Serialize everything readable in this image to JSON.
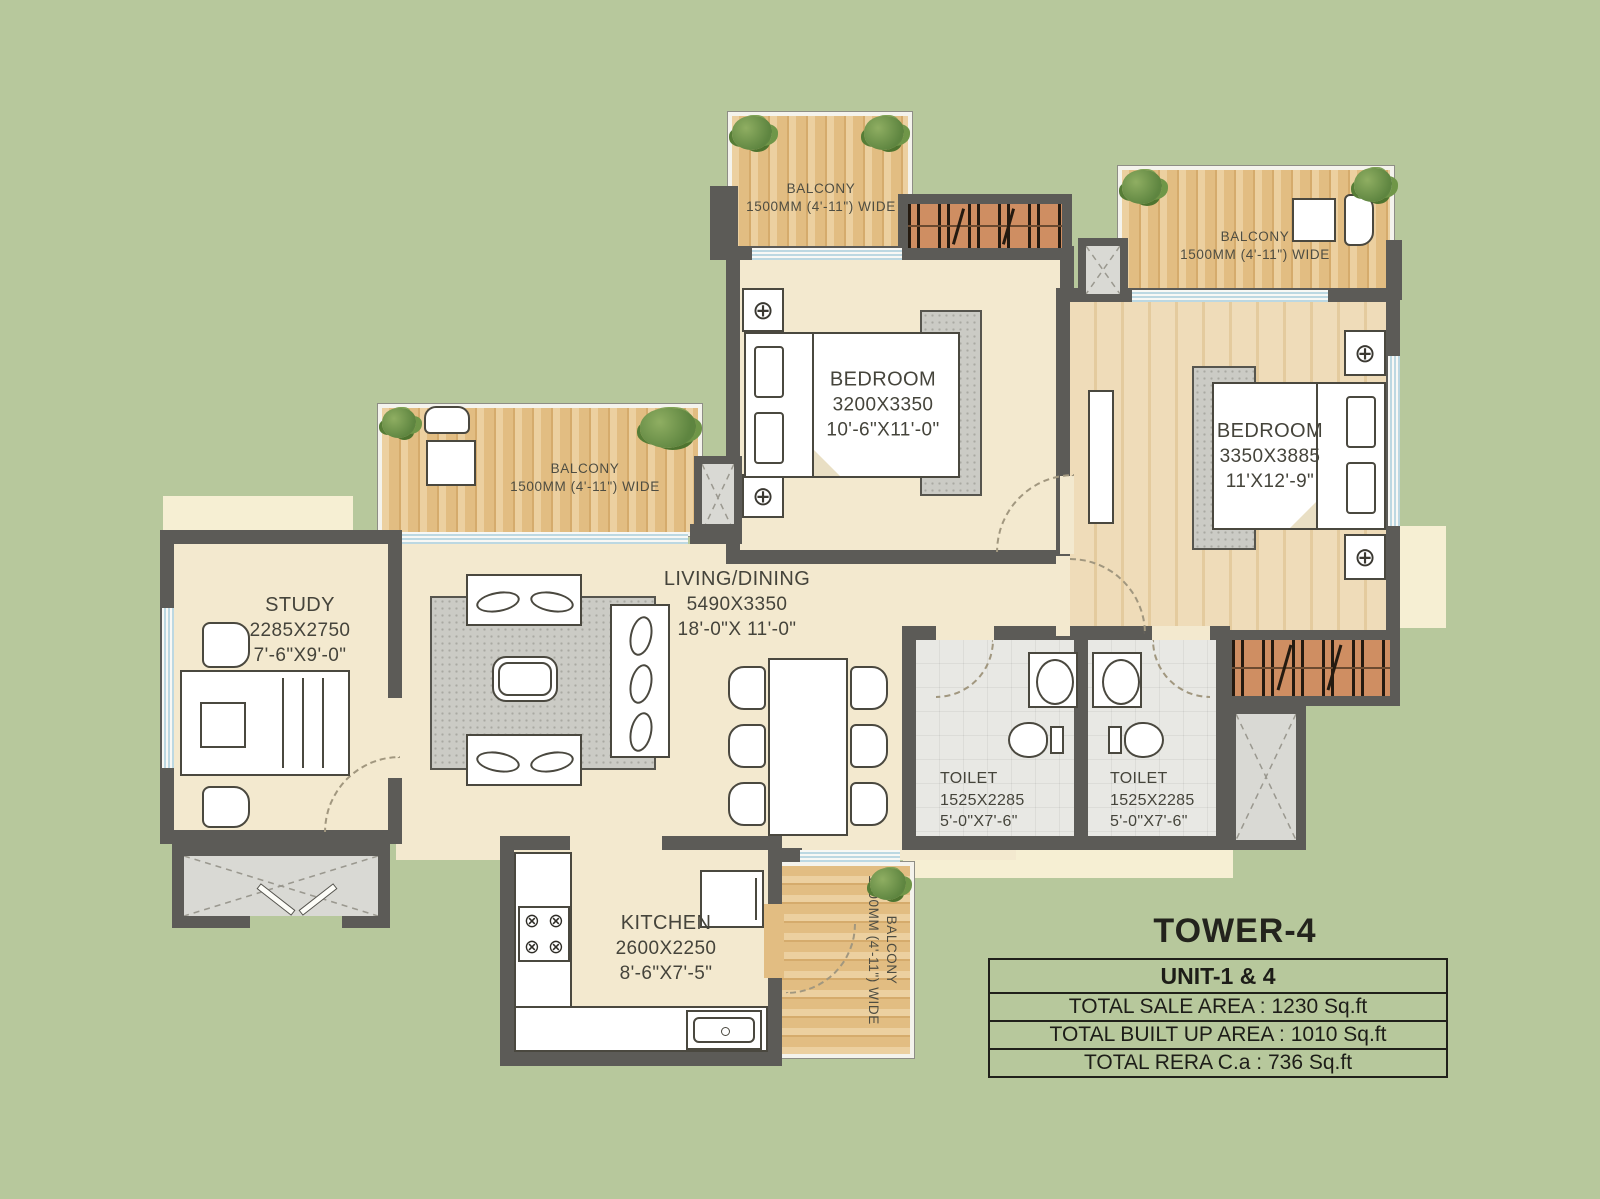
{
  "title": {
    "tower": "TOWER-4"
  },
  "info_table": {
    "unit_label": "UNIT-1 & 4",
    "rows": [
      "TOTAL SALE AREA : 1230 Sq.ft",
      "TOTAL BUILT  UP AREA : 1010 Sq.ft",
      "TOTAL RERA C.a : 736 Sq.ft"
    ]
  },
  "rooms": {
    "bedroom1": {
      "name": "BEDROOM",
      "dim_mm": "3200X3350",
      "dim_ft": "10'-6\"X11'-0\""
    },
    "bedroom2": {
      "name": "BEDROOM",
      "dim_mm": "3350X3885",
      "dim_ft": "11'X12'-9\""
    },
    "living": {
      "name": "LIVING/DINING",
      "dim_mm": "5490X3350",
      "dim_ft": "18'-0\"X 11'-0\""
    },
    "study": {
      "name": "STUDY",
      "dim_mm": "2285X2750",
      "dim_ft": "7'-6\"X9'-0\""
    },
    "kitchen": {
      "name": "KITCHEN",
      "dim_mm": "2600X2250",
      "dim_ft": "8'-6\"X7'-5\""
    },
    "toilet1": {
      "name": "TOILET",
      "dim_mm": "1525X2285",
      "dim_ft": "5'-0\"X7'-6\""
    },
    "toilet2": {
      "name": "TOILET",
      "dim_mm": "1525X2285",
      "dim_ft": "5'-0\"X7'-6\""
    }
  },
  "balconies": {
    "top": {
      "name": "BALCONY",
      "size": "1500MM (4'-11\") WIDE"
    },
    "right": {
      "name": "BALCONY",
      "size": "1500MM (4'-11\") WIDE"
    },
    "left": {
      "name": "BALCONY",
      "size": "1500MM (4'-11\") WIDE"
    },
    "bottom": {
      "name": "BALCONY",
      "size": "1500MM (4'-11\") WIDE"
    }
  },
  "colors": {
    "background": "#b7c89c",
    "wall": "#5c5b57",
    "floor_cream": "#f3e9cf",
    "wood_balcony": "#e4bf86",
    "wood_bedroom": "#ead3ab",
    "tile": "#e8e8e4",
    "wardrobe": "#cf8e62",
    "glass": "#bcd8e2",
    "plinth": "#f6efd3"
  }
}
